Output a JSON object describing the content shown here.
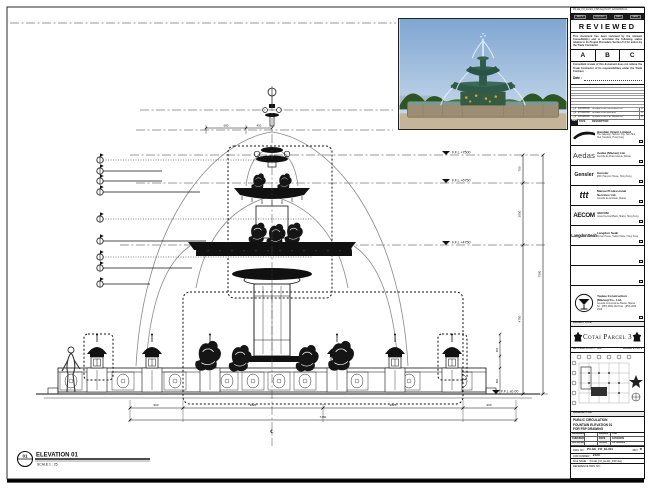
{
  "sheet": {
    "corner_note": "P3-GE_FO_EL401_FSP.dwg  PLOT: 12/04/2009  A1",
    "ink": "#1a1a1a"
  },
  "stamp": {
    "header_cells": [
      "REC'D",
      "DOC NO.",
      "REV",
      "DATE"
    ],
    "title": "REVIEWED",
    "para1": "This document has been reviewed by the relevant Consultant(s) and is accorded the following status relative to its Project Procedure Section 5.4 for action by the Trade Contractor.",
    "grades": [
      "A",
      "B",
      "C"
    ],
    "para2": "Consultant review of this document does not relieve the Trade Contractor of its responsibilities under the Trade Contract.",
    "date_label": "Date :"
  },
  "revisions": {
    "header": {
      "rev": "REV",
      "date": "DATE",
      "desc": "DESCRIPTION"
    },
    "rows": [
      {
        "rev": "△1",
        "date": "10/03/2009",
        "desc": "ISSUED FOR INFORMATION",
        "by": "A"
      },
      {
        "rev": "△2",
        "date": "27/03/2009",
        "desc": "ISSUED FOR REVIEW",
        "by": "A"
      },
      {
        "rev": "△3",
        "date": "12/04/2009",
        "desc": "ISSUED FOR FSP DRAWING",
        "by": "B"
      }
    ]
  },
  "consultants": [
    {
      "logo": "",
      "name": "Handian Orient Limited",
      "addr": "The Gateway, Harbour City, Tsim Sha Tsui, Kowloon, Hong Kong"
    },
    {
      "logo": "Aedas",
      "name": "Aedas (Macau) Ltd.",
      "addr": "Avenida da Praia Grande, Macau"
    },
    {
      "logo": "Gensler",
      "name": "Gensler",
      "addr": "28/F, Harcourt House, Hong Kong"
    },
    {
      "logo": "ttt",
      "name": "Macau Professional Services Ltd.",
      "addr": "Avenida da Amizade, Macau"
    },
    {
      "logo": "AECOM",
      "name": "AECOM",
      "addr": "Grand Central Plaza, Shatin, Hong Kong"
    },
    {
      "logo": "LangdonSeah",
      "name": "Langdon Seah",
      "addr": "Dorset House, Taikoo Place, Hong Kong"
    },
    {
      "logo": "",
      "name": "",
      "addr": ""
    },
    {
      "logo": "",
      "name": "",
      "addr": ""
    }
  ],
  "contractor": {
    "name": "Yaulee Construction (Macau) Co., Ltd.",
    "addr": "Avenida Comercial de Macau, Macau",
    "tel": "Tel : (853) 2832 2323   Fax : (853) 2832 2329"
  },
  "project": {
    "label": "PROJECT TITLE",
    "title": "Cotai Parcel 3"
  },
  "key_plan": {
    "label": "KEY PLAN",
    "scale": "SCALE 1 : 2000",
    "lot": "PARCEL 3, LOT 2"
  },
  "title_block": {
    "label": "DRAWING TITLE",
    "line1": "PUBLIC CIRCULATION",
    "line2": "FOUNTAIN ELEVATION 01",
    "line3": "FOR FSP DRAWING",
    "designed_label": "DESIGNED",
    "designed": "",
    "drawn_label": "DRAWN",
    "drawn": "CAD",
    "checked_label": "CHECKED",
    "checked": "-",
    "date_label": "DATE",
    "date": "12/04/2009",
    "approved_label": "APPROVED",
    "approved": "-",
    "scale_label": "SCALE",
    "scale": "AS SHOWN",
    "dwg_label": "DWG NO :",
    "dwg_no": "P3-GE_FO_EL401",
    "rev_label": "REV",
    "rev": "B",
    "job_label": "JOB NUMBER :",
    "job_no": "2123",
    "file_label": "FILE NAME :",
    "file_name": "P3-GE_FO_EL401_FSP.dwg",
    "ref_label": "REFERENCE DWG NO :"
  },
  "drawing": {
    "levels": [
      "F.F.L +7500",
      "F.F.L +6750",
      "F.F.L +4750",
      "F.F.L ±0.00"
    ],
    "vdims": [
      "750",
      "2000",
      "4750",
      "7500"
    ],
    "lamp_dims": [
      "450",
      "800"
    ],
    "top_dims": [
      "680",
      "450"
    ],
    "bottom_dims": [
      "900",
      "2825",
      "2825",
      "900"
    ],
    "bottom_total": "7450",
    "center_symbol": "℄",
    "view_no": "01",
    "view_title": "ELEVATION 01",
    "view_scale": "SCALE  1 : 25"
  }
}
